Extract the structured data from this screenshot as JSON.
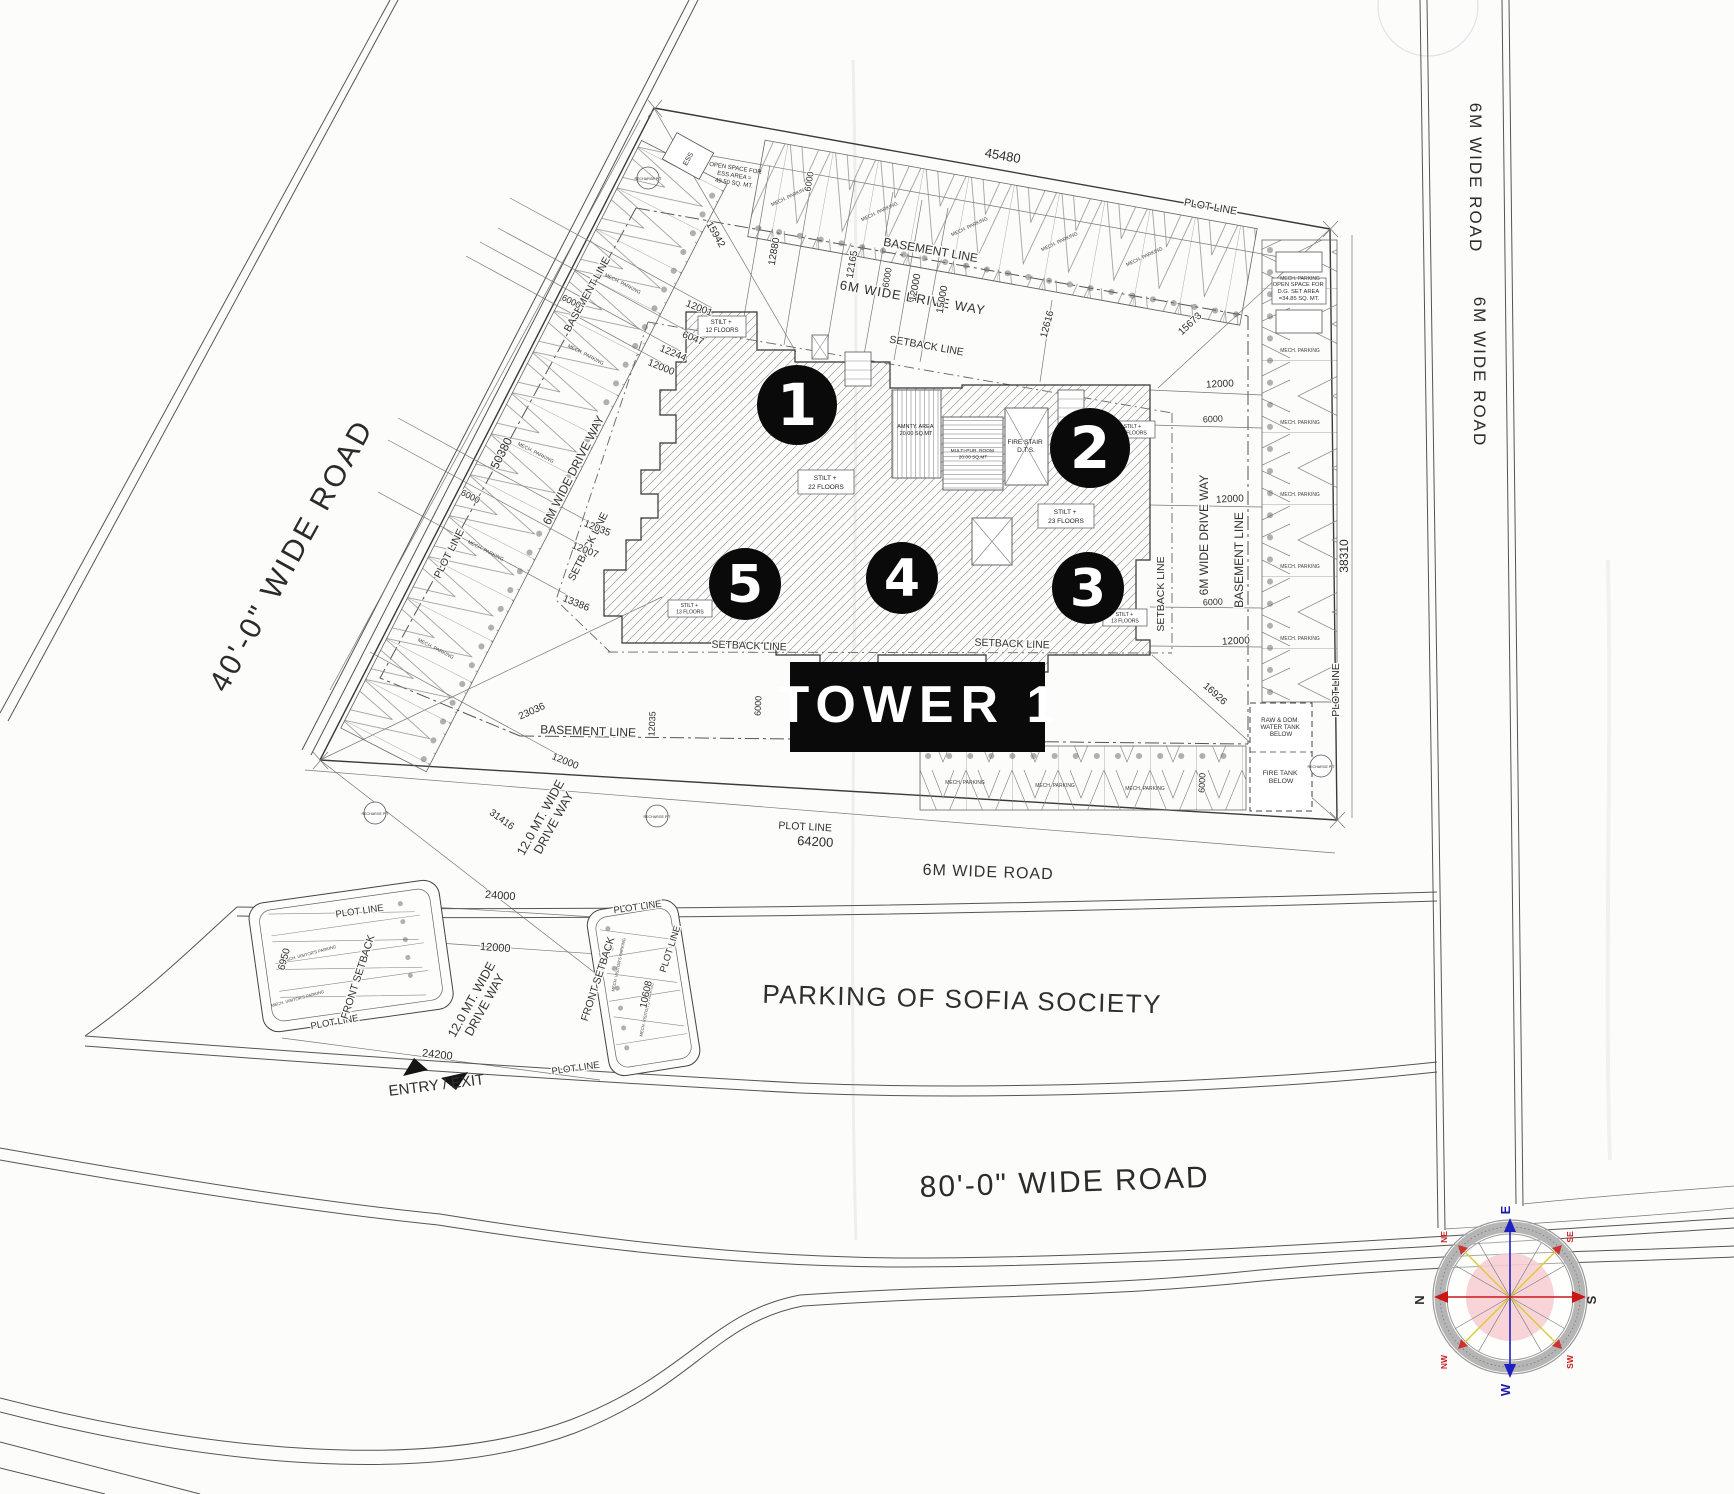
{
  "plan": {
    "tower_banner": "TOWER 1",
    "markers": {
      "m1": "1",
      "m2": "2",
      "m3": "3",
      "m4": "4",
      "m5": "5"
    },
    "buildings": {
      "b12": {
        "l1": "STILT +",
        "l2": "12 FLOORS"
      },
      "b22": {
        "l1": "STILT +",
        "l2": "22 FLOORS"
      },
      "b23": {
        "l1": "STILT +",
        "l2": "23 FLOORS"
      },
      "b13": {
        "l1": "STILT +",
        "l2": "13 FLOORS"
      }
    },
    "rooms": {
      "amenity": {
        "l1": "AMNTY. AREA",
        "l2": "20.00 SQ.MT"
      },
      "multi": {
        "l1": "MULTI-PUR. ROOM",
        "l2": "20.00 SQ.MT"
      },
      "fire": {
        "l1": "FIRE STAIR",
        "l2": "D.T.S."
      }
    },
    "ess": "ESS",
    "open_ess": {
      "l1": "OPEN SPACE FOR",
      "l2": "ESS AREA =",
      "l3": "49.50 SQ. MT."
    },
    "open_dg": {
      "l1": "OPEN SPACE FOR",
      "l2": "D.G. SET AREA",
      "l3": "=34.85 SQ. MT."
    },
    "tanks": {
      "raw": {
        "l1": "RAW & DOM.",
        "l2": "WATER TANK",
        "l3": "BELOW"
      },
      "fire": {
        "l1": "FIRE TANK",
        "l2": "BELOW"
      }
    },
    "recharge": "RECHARGE PIT"
  },
  "roads": {
    "west": "40'-0\" WIDE ROAD",
    "south": "80'-0\" WIDE ROAD",
    "east": "6M WIDE ROAD"
  },
  "drives": {
    "d6m": "6M WIDE DRIVE WAY",
    "d12": {
      "l1": "12.0 MT. WIDE",
      "l2": "DRIVE WAY"
    }
  },
  "lines": {
    "plot": "PLOT LINE",
    "basement": "BASEMENT LINE",
    "setback": "SETBACK LINE",
    "front_setback": "FRONT SETBACK"
  },
  "parking": {
    "mech": "MECH. PARKING",
    "visitor": "MECH. VISITOR'S PARKING",
    "society": "PARKING OF SOFIA SOCIETY",
    "entry_exit": "ENTRY / EXIT"
  },
  "compass": {
    "n": "N",
    "s": "S",
    "e": "E",
    "w": "W",
    "ne": "NE",
    "nw": "NW",
    "se": "SE",
    "sw": "SW"
  },
  "dims": {
    "d45480": "45480",
    "d50380": "50380",
    "d38310": "38310",
    "d64200": "64200",
    "d24000": "24000",
    "d24200": "24200",
    "d12000": "12000",
    "d6000": "6000",
    "d6950": "6950",
    "d10608": "10608",
    "d31416": "31416",
    "d23036": "23036",
    "d16926": "16926",
    "d15942": "15942",
    "d15673": "15673",
    "d12880": "12880",
    "d12165": "12165",
    "d12616": "12616",
    "d15000": "15000",
    "d12001": "12001",
    "d6047": "6047",
    "d12244": "12244",
    "d12035": "12035",
    "d12007": "12007",
    "d13386": "13386"
  }
}
